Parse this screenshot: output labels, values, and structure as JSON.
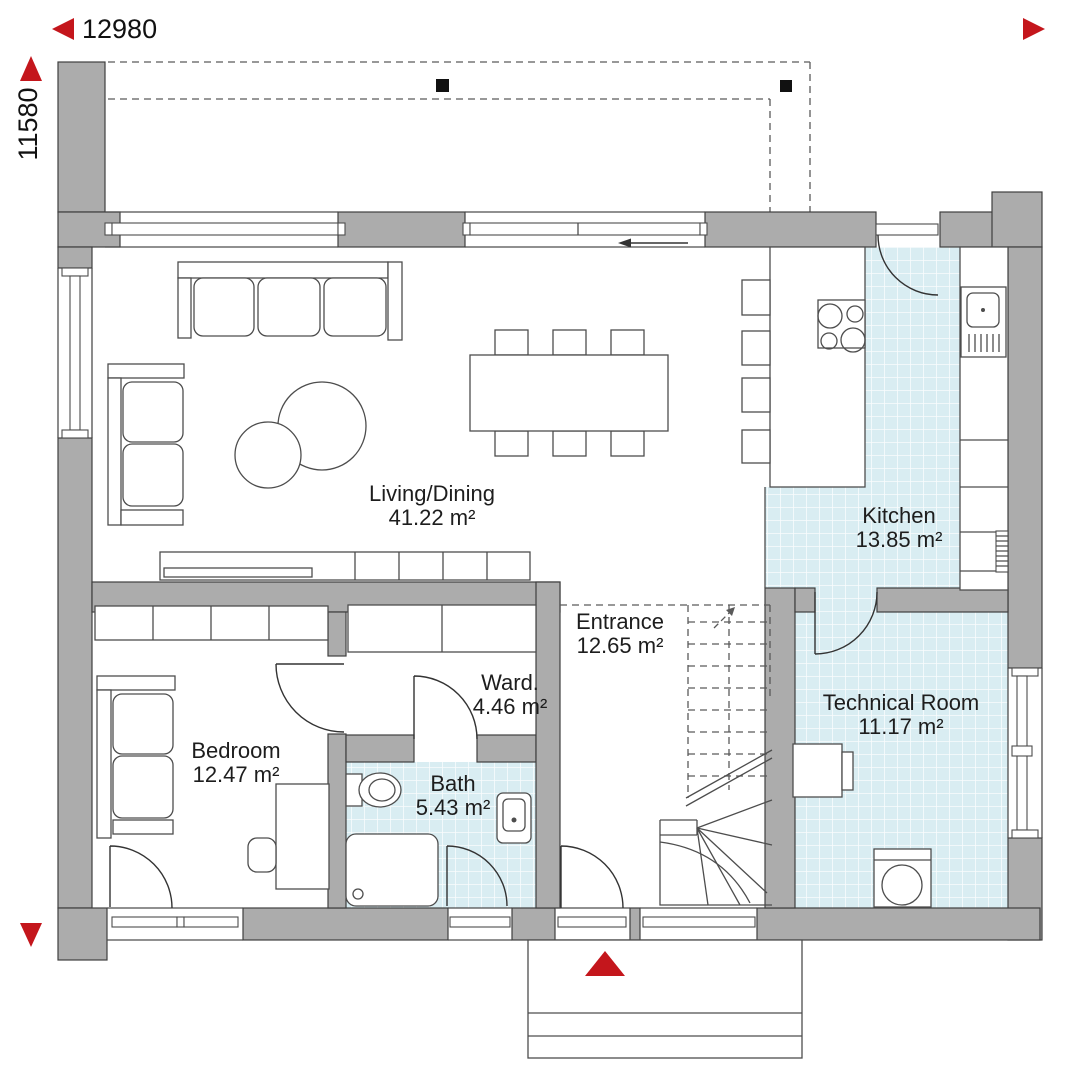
{
  "plan": {
    "dimension_width": "12980",
    "dimension_height": "11580",
    "rooms": {
      "living": {
        "name": "Living/Dining",
        "area": "41.22 m²"
      },
      "kitchen": {
        "name": "Kitchen",
        "area": "13.85 m²"
      },
      "entrance": {
        "name": "Entrance",
        "area": "12.65 m²"
      },
      "wardrobe": {
        "name": "Ward.",
        "area": "4.46 m²"
      },
      "bedroom": {
        "name": "Bedroom",
        "area": "12.47 m²"
      },
      "bath": {
        "name": "Bath",
        "area": "5.43 m²"
      },
      "technical": {
        "name": "Technical Room",
        "area": "11.17 m²"
      }
    },
    "colors": {
      "accent_red": "#c4161c",
      "tile_blue": "#d9edf2",
      "wall_gray": "#acacac"
    },
    "icons": {
      "dimension_arrows": "red solid triangles (left, up, right, down)",
      "entrance_marker": "red solid triangle pointing up",
      "roof_posts": "small black squares",
      "sliding_door_arrow": "thin left arrow",
      "stairs_up_arrow": "small diagonal arrow"
    }
  }
}
